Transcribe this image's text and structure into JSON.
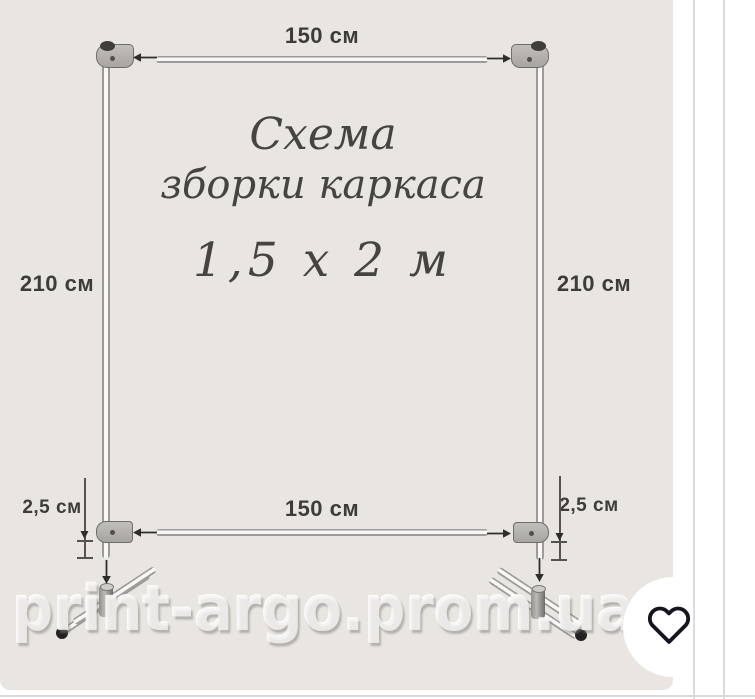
{
  "diagram": {
    "title_line1": "Схема",
    "title_line2": "зборки каркаса",
    "title_line3": "1,5 х 2 м",
    "dim_top": "150 см",
    "dim_bottom": "150 см",
    "dim_left": "210 см",
    "dim_right": "210 см",
    "dim_offset_left": "2,5 см",
    "dim_offset_right": "2,5 см",
    "watermark": "print-argo.prom.ua"
  },
  "icons": {
    "favorite": "heart-outline"
  },
  "colors": {
    "card_background": "#e9e6e1",
    "label_text": "#3d3c3a",
    "title_text": "#454440",
    "tube_edge": "#9d9b97",
    "connector_fill": "#b3b0ab",
    "heart_stroke": "#15151f",
    "divider_line": "#dcdade"
  }
}
